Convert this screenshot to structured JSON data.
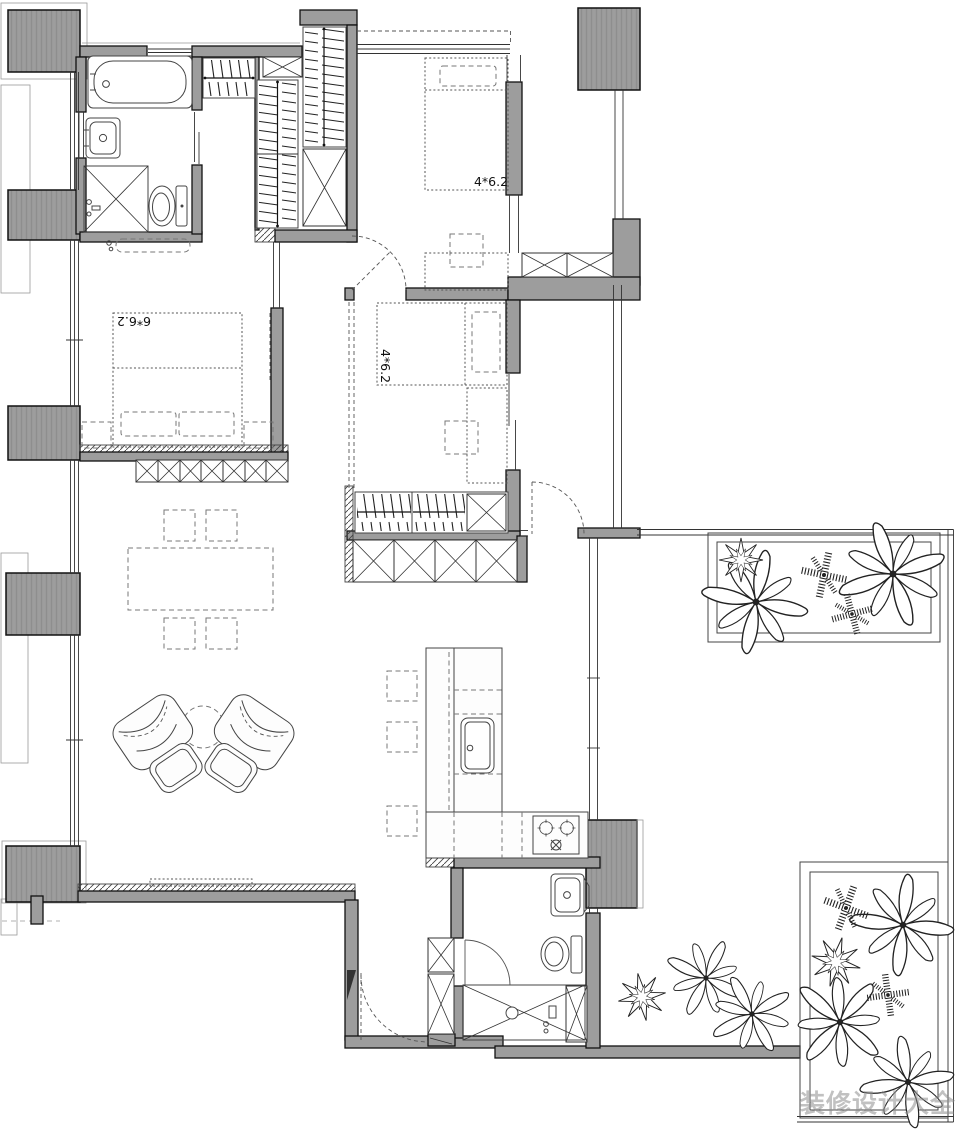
{
  "labels": {
    "bedroom_top_right": "4*6.2",
    "bedroom_master": "6*6.2",
    "bedroom_middle": "4*6.2"
  },
  "watermark": "装修设计大全",
  "colors": {
    "wall_fill": "#9d9d9d",
    "line_dark": "#1a1a1a",
    "watermark_gray": "#8f8f8f"
  }
}
